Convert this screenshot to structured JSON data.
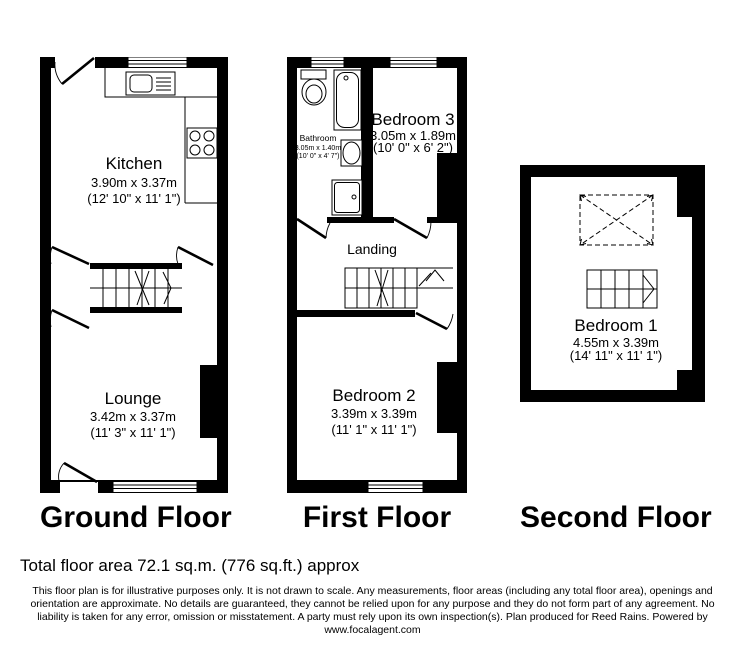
{
  "colors": {
    "wall": "#000000",
    "background": "#ffffff",
    "text": "#000000"
  },
  "floors": {
    "ground": {
      "label": "Ground Floor",
      "rooms": {
        "kitchen": {
          "name": "Kitchen",
          "metric": "3.90m x 3.37m",
          "imperial": "(12' 10\" x 11' 1\")"
        },
        "lounge": {
          "name": "Lounge",
          "metric": "3.42m x 3.37m",
          "imperial": "(11' 3\" x 11' 1\")"
        }
      }
    },
    "first": {
      "label": "First Floor",
      "rooms": {
        "bathroom": {
          "name": "Bathroom",
          "metric": "3.05m x 1.40m",
          "imperial": "(10' 0\" x 4' 7\")"
        },
        "bedroom3": {
          "name": "Bedroom 3",
          "metric": "3.05m x 1.89m",
          "imperial": "(10' 0\" x 6' 2\")"
        },
        "landing": {
          "name": "Landing"
        },
        "bedroom2": {
          "name": "Bedroom 2",
          "metric": "3.39m x 3.39m",
          "imperial": "(11' 1\" x 11' 1\")"
        }
      }
    },
    "second": {
      "label": "Second Floor",
      "rooms": {
        "bedroom1": {
          "name": "Bedroom 1",
          "metric": "4.55m x 3.39m",
          "imperial": "(14' 11\" x 11' 1\")"
        }
      }
    }
  },
  "footer": {
    "total_area": "Total floor area 72.1 sq.m. (776 sq.ft.) approx",
    "disclaimer": [
      "This floor plan is for illustrative purposes only. It is not drawn to scale. Any measurements, floor areas (including any total floor area), openings and",
      "orientation are approximate. No details are guaranteed, they cannot be relied upon for any purpose and they do not form part of any agreement. No",
      "liability is taken for any error, omission or misstatement. A party must rely upon its own inspection(s). Plan produced for Reed Rains. Powered by",
      "www.focalagent.com"
    ]
  }
}
